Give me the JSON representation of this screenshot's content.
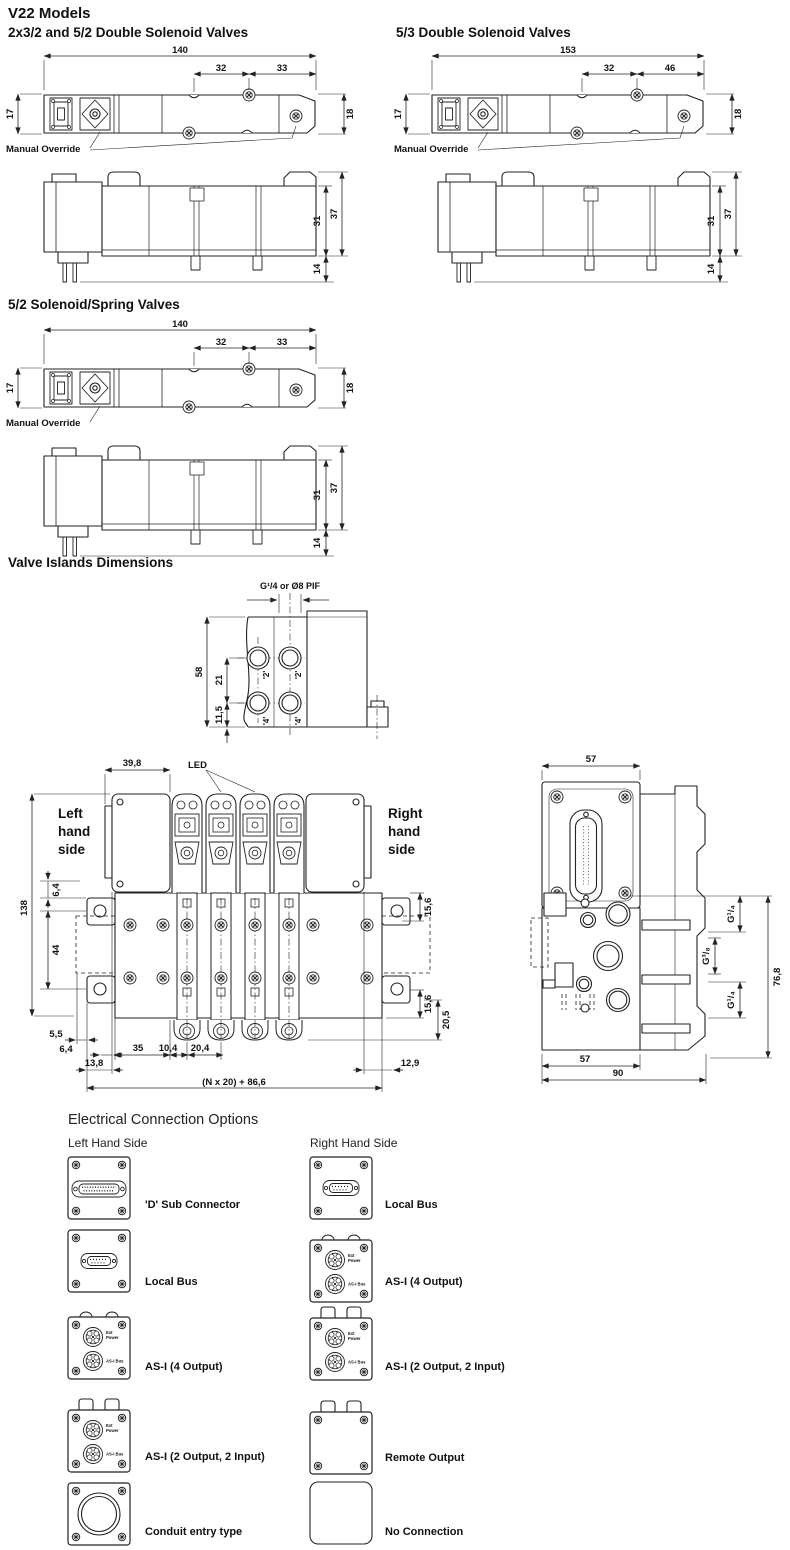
{
  "page": {
    "title": "V22  Models"
  },
  "valve_a": {
    "title": "2x3/2 and 5/2 Double Solenoid Valves",
    "manual_override": "Manual Override",
    "dims": {
      "overall": "140",
      "seg1": "32",
      "seg2": "33",
      "h_left": "17",
      "h_right": "18",
      "side_body": "31",
      "side_total": "37",
      "side_pins": "14"
    }
  },
  "valve_b": {
    "title": "5/3 Double Solenoid Valves",
    "manual_override": "Manual Override",
    "dims": {
      "overall": "153",
      "seg1": "32",
      "seg2": "46",
      "h_left": "17",
      "h_right": "18",
      "side_body": "31",
      "side_total": "37",
      "side_pins": "14"
    }
  },
  "valve_c": {
    "title": "5/2 Solenoid/Spring Valves",
    "manual_override": "Manual Override",
    "dims": {
      "overall": "140",
      "seg1": "32",
      "seg2": "33",
      "h_left": "17",
      "h_right": "18",
      "side_body": "31",
      "side_total": "37",
      "side_pins": "14"
    }
  },
  "islands": {
    "title": "Valve Islands Dimensions",
    "end_view": {
      "thread_label": "G¹/4 or Ø8 PIF",
      "dims": {
        "height": "58",
        "pitch": "21",
        "offset": "11,5"
      },
      "ports": {
        "top": "'2'",
        "bottom": "'4'"
      }
    },
    "front_view": {
      "led": "LED",
      "left_side": [
        "Left",
        "hand",
        "side"
      ],
      "right_side": [
        "Right",
        "hand",
        "side"
      ],
      "dims": {
        "end_width": "39,8",
        "top_offset": "6,4",
        "height": "138",
        "slot": "44",
        "right_top": "15,6",
        "right_bottom": "15,6",
        "port_offset": "20,5",
        "b_55": "5,5",
        "b_64": "6,4",
        "b_35": "35",
        "b_104": "10,4",
        "b_204": "20,4",
        "b_138": "13,8",
        "b_129": "12,9",
        "total": "(N x 20) + 86,6"
      }
    },
    "side_view": {
      "dims": {
        "top_width": "57",
        "g_top": "G¹/₄",
        "g_mid": "G³/₈",
        "g_bottom": "G¹/₄",
        "height": "76,8",
        "bottom_width": "57",
        "overall_width": "90"
      }
    }
  },
  "electrical": {
    "title": "Electrical Connection Options",
    "left_header": "Left Hand Side",
    "right_header": "Right Hand Side",
    "asi": {
      "ext": "Ext",
      "power": "Power",
      "bus": "AS-I Bus"
    },
    "left_items": [
      "'D' Sub Connector",
      "Local Bus",
      "AS-I (4 Output)",
      "AS-I (2 Output, 2 Input)",
      "Conduit entry type"
    ],
    "right_items": [
      "Local Bus",
      "AS-I (4 Output)",
      "AS-I (2 Output, 2 Input)",
      "Remote Output",
      "No Connection"
    ]
  },
  "colors": {
    "line": "#222222",
    "text": "#111111",
    "background": "#ffffff"
  }
}
